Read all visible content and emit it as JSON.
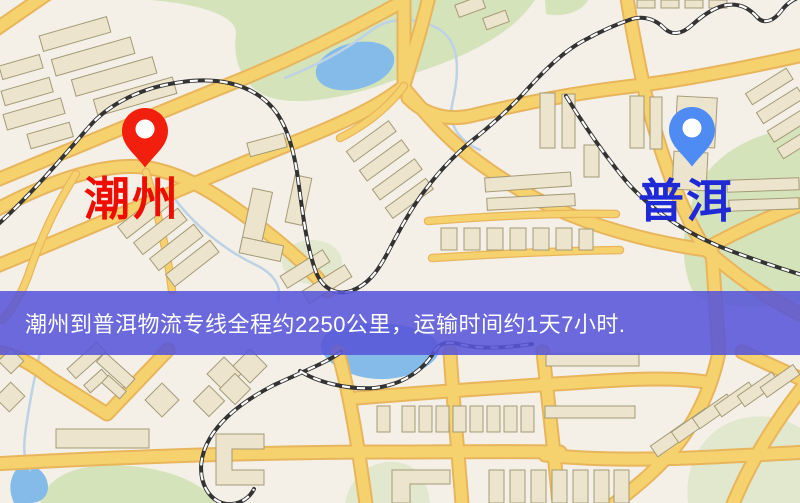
{
  "map": {
    "origin": {
      "name": "潮州",
      "pin": "red-pin"
    },
    "destination": {
      "name": "普洱",
      "pin": "blue-pin"
    },
    "banner": {
      "text": "潮州到普洱物流专线全程约2250公里，运输时间约1天7小时."
    },
    "route": {
      "distance": "约2250公里",
      "duration": "约1天7小时"
    }
  },
  "colors": {
    "bg": "#f4f0e8",
    "park": "#d4e3ba",
    "park2": "#e1e8cd",
    "water": "#85bbe8",
    "stream": "#bdd2e4",
    "road": "#f6d26e",
    "road-edge": "#e8b55c",
    "rail": "#333333",
    "rail-dash": "#ffffff",
    "bldg": "#ece4cc",
    "bldg-edge": "#a59a76",
    "banner": "rgba(88,85,216,0.88)",
    "banner-text": "#ffffff",
    "pin-red": "#f31f0e",
    "pin-blue": "#4e8bf2",
    "label-red": "#ee0d00",
    "label-blue": "#2029d6"
  }
}
